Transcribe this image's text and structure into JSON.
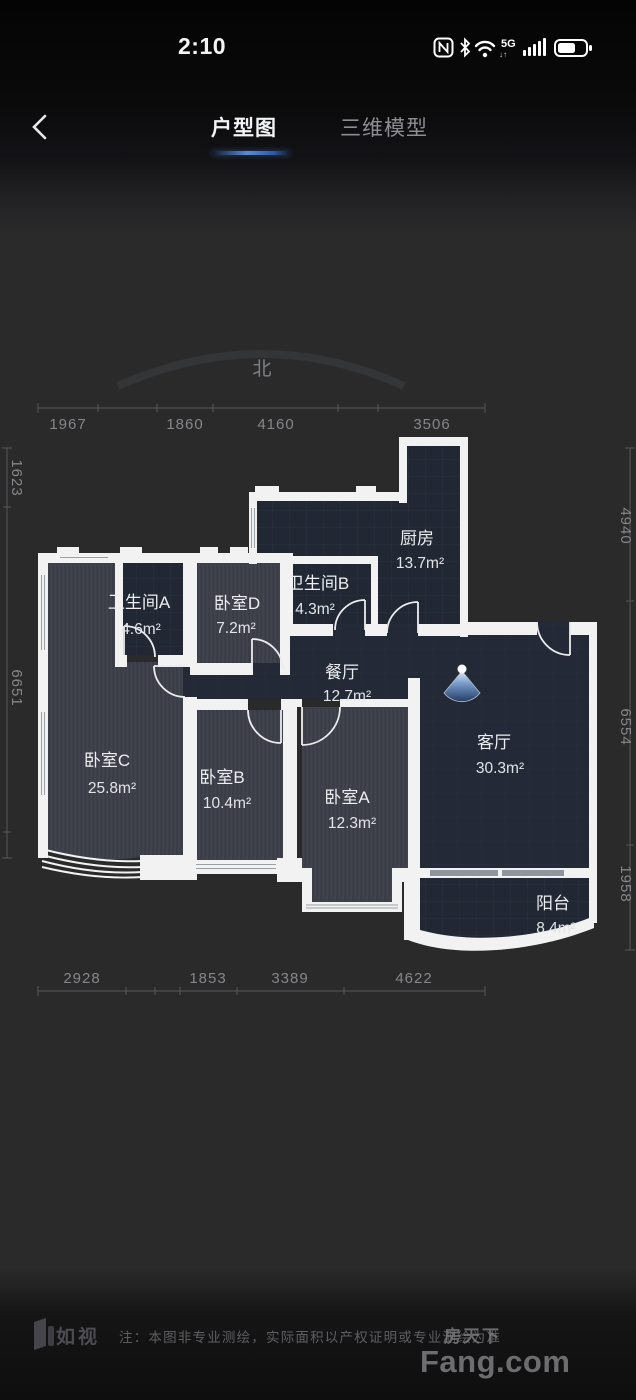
{
  "status_bar": {
    "time": "2:10",
    "network": "5G"
  },
  "nav": {
    "tab_active": "户型图",
    "tab_inactive": "三维模型"
  },
  "compass": {
    "north_label": "北"
  },
  "rooms": [
    {
      "id": "kitchen",
      "name": "厨房",
      "area": "13.7m²"
    },
    {
      "id": "bath-a",
      "name": "卫生间A",
      "area": "4.6m²"
    },
    {
      "id": "bed-d",
      "name": "卧室D",
      "area": "7.2m²"
    },
    {
      "id": "bath-b",
      "name": "卫生间B",
      "area": "4.3m²"
    },
    {
      "id": "dining",
      "name": "餐厅",
      "area": "12.7m²"
    },
    {
      "id": "living",
      "name": "客厅",
      "area": "30.3m²"
    },
    {
      "id": "bed-c",
      "name": "卧室C",
      "area": "25.8m²"
    },
    {
      "id": "bed-b",
      "name": "卧室B",
      "area": "10.4m²"
    },
    {
      "id": "bed-a",
      "name": "卧室A",
      "area": "12.3m²"
    },
    {
      "id": "balcony",
      "name": "阳台",
      "area": "8.4m²"
    }
  ],
  "dimensions": {
    "top": [
      "1967",
      "1860",
      "4160",
      "3506"
    ],
    "bottom": [
      "2928",
      "1853",
      "3389",
      "4622"
    ],
    "left": [
      "1623",
      "6651"
    ],
    "right": [
      "4940",
      "6554",
      "1958"
    ]
  },
  "footer": {
    "brand": "如视",
    "note": "注：本图非专业测绘，实际面积以产权证明或专业测绘为准"
  },
  "watermark": {
    "cn": "房天下",
    "en": "Fang.com"
  },
  "colors": {
    "accent_blue": "#4a85e8",
    "wall_white": "#f2f2f3",
    "room_navy": "#222835",
    "room_wood": "#3b3e47"
  }
}
